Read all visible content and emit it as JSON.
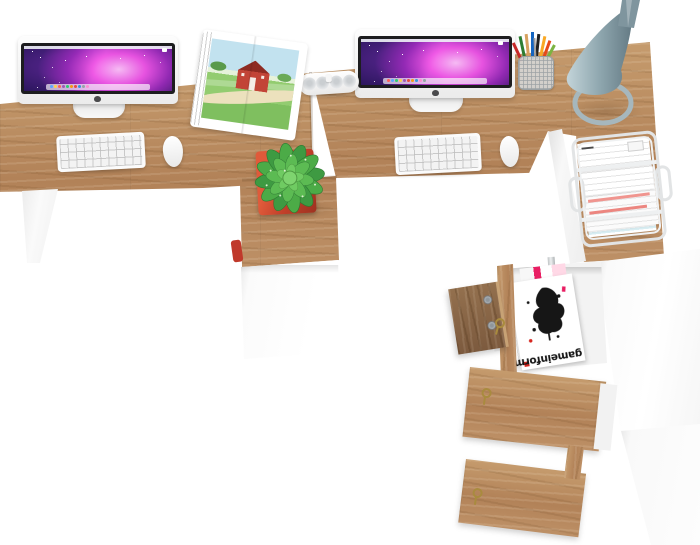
{
  "scene": {
    "type": "furniture-product-render",
    "view": "top-down",
    "description": "White and oak two-person corner desk workstation with computers, plant, designer lamp, paper tray and magazine cabinet, seen from above",
    "background_color": "#ffffff"
  },
  "colors": {
    "wood_light": "#c59b6d",
    "wood_mid": "#b28258",
    "wood_dark": "#8d6843",
    "door_inner_wood": "#7c5a3e",
    "panel_white": "#fbfbfb",
    "screen_magenta": "#f457e8",
    "screen_dark_blue": "#16103a",
    "plant_green": "#4cab47",
    "pot_red": "#c2402a",
    "lamp_blue_gray": "#8fa7af",
    "paper_highlight_red": "#ee8f88",
    "brass_key": "#a98b3e",
    "speaker_white": "#f4f5f6"
  },
  "stations": {
    "left": {
      "items": [
        "imac-computer",
        "apple-keyboard",
        "apple-mouse",
        "open-picture-book",
        "potted-plant",
        "white-drawer-cabinet"
      ]
    },
    "right": {
      "items": [
        "imac-computer",
        "apple-keyboard",
        "apple-mouse",
        "pill-speaker",
        "pencil-cup",
        "designer-lamp",
        "wire-letter-tray"
      ]
    }
  },
  "cabinet": {
    "magazine": {
      "title": "gameinformer",
      "orientation": "upside-down"
    },
    "doors": [
      "open-wood-door",
      "wood-door-with-key",
      "wood-door-with-key"
    ]
  }
}
